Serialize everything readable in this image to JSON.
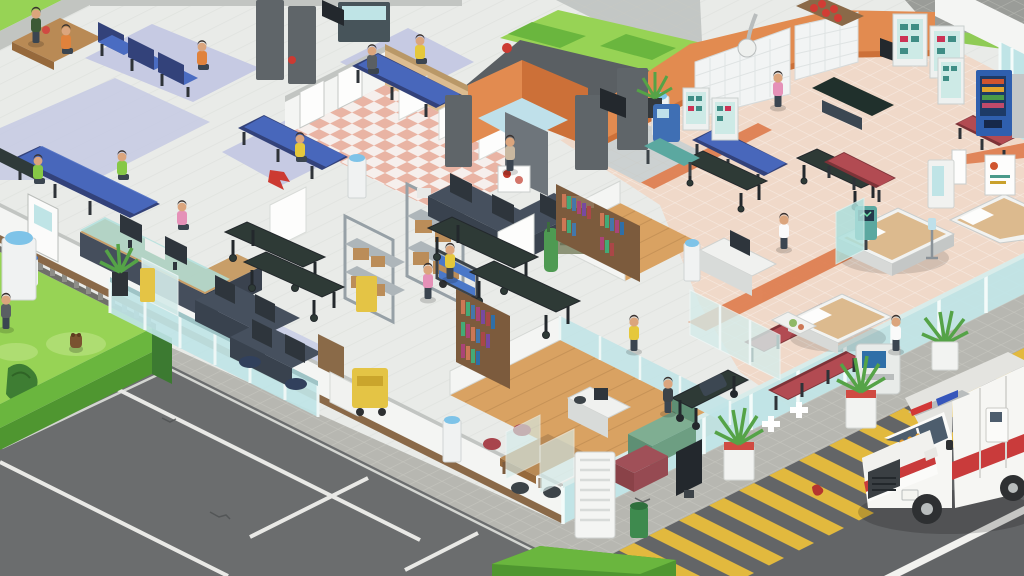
{
  "meta": {
    "view": "isometric-hospital-simulation-scene",
    "hud_text": ""
  },
  "palette": {
    "floor_base": "#e9ebe8",
    "plank_line": "#dde0dc",
    "rug_lavender": "#c6cae3",
    "office_floor": "#ccd1e6",
    "checker_a": "#f6efec",
    "checker_b": "#e9b4a4",
    "ward_tile": "#f0d9c9",
    "runner_orange": "#de7b4c",
    "wood_floor": "#d9a262",
    "wood_line": "#bb8950",
    "desk_wood": "#c89e68",
    "wall_white": "#f4f5f3",
    "wall_shade": "#e0e2df",
    "wall_cap": "#c2c5c2",
    "wall_beige": "#dcbc90",
    "wall_orange": "#e28b50",
    "wall_orange_dark": "#cc7038",
    "wall_dark": "#5a5f63",
    "grid_wall": "#f2f4f4",
    "glass_teal": "#bfe4e6",
    "glass_frame": "#eef7f6",
    "locker_dark": "#59666c",
    "locker_teal": "#47727a",
    "cabinet_glass": "#cdeae6",
    "chair_blue": "#4a6cc2",
    "chair_blue_dark": "#33427a",
    "chair_red": "#b24b52",
    "sofa_green": "#7fae92",
    "ottoman_red": "#a05058",
    "bookshelf_brown": "#7c5b3d",
    "shelf_metal": "#96a0a6",
    "box_brown": "#bb8d59",
    "bin_yellow": "#e4c445",
    "grass_bright": "#97d355",
    "grass_patch": "#aedd72",
    "hedge_top": "#6ab63e",
    "hedge_side": "#4f9630",
    "hedge_dark": "#3c7a31",
    "fence_gray": "#8e8e88",
    "parking": "#6b6d6e",
    "parking_line": "#e9e9e6",
    "sidewalk": "#b7b7b1",
    "sidewalk_line": "#c9c9c2",
    "hatch_yellow": "#e2b93e",
    "road": "#636567",
    "road_line": "#f2f2ef",
    "amb_body": "#f6f6f3",
    "amb_shade": "#dddddad",
    "amb_stripe": "#c93b3b",
    "amb_glass": "#4d5d6d",
    "light_red": "#d23737",
    "light_blue": "#3656bb",
    "tire": "#2e3032",
    "monitor_dark": "#2e353c",
    "screen_blue": "#4c6a85",
    "skin": "#dba57d",
    "hair_dark": "#3a3230",
    "scrub_pink": "#e591b8",
    "scrub_yellow": "#e5c83c",
    "coat_white": "#fafafa",
    "uniform_dark": "#3c4348",
    "shirt_green": "#86c846",
    "shirt_orange": "#e0823c",
    "plant_green": "#55a347",
    "pot_white": "#f2f3f1",
    "pot_red": "#d04a42",
    "water_blue": "#7ec3e8",
    "blood_red": "#b5352f",
    "olive_cab": "#8d9478",
    "coat_rack_green": "#4e9a52",
    "vending_blue": "#2f5fae",
    "bear_brown": "#7a5230"
  },
  "scene": {
    "areas": [
      {
        "id": "waiting-lobby",
        "label": "waiting lobby with blue seat rows"
      },
      {
        "id": "restrooms",
        "label": "restrooms with pink checkered floor"
      },
      {
        "id": "reception",
        "label": "reception desk with receptionist"
      },
      {
        "id": "open-office",
        "label": "open office with computer desks"
      },
      {
        "id": "storage-corridor",
        "label": "supply corridor with racks and carts"
      },
      {
        "id": "nurse-station",
        "label": "nurse station counters"
      },
      {
        "id": "records-room",
        "label": "records room with bookshelves"
      },
      {
        "id": "staff-lounge",
        "label": "staff lounge with sofa and tv"
      },
      {
        "id": "operating-suite",
        "label": "operating suite with orange walls"
      },
      {
        "id": "inpatient-ward",
        "label": "inpatient ward with beds"
      },
      {
        "id": "entrance",
        "label": "glass entrance with cross decals"
      },
      {
        "id": "vending-corner",
        "label": "vending machine corner"
      },
      {
        "id": "parking-lot",
        "label": "parking lot"
      },
      {
        "id": "ambulance-bay",
        "label": "street with hatched ambulance bay"
      },
      {
        "id": "garden",
        "label": "garden with hedge, fence and groundhog"
      }
    ],
    "people": [
      {
        "id": "visitor-walking-topleft",
        "outfit": "dark green jacket"
      },
      {
        "id": "visitor-orange-table",
        "outfit": "orange shirt"
      },
      {
        "id": "visitor-orange-seated",
        "outfit": "orange shirt"
      },
      {
        "id": "visitor-gray-seated",
        "outfit": "gray jacket"
      },
      {
        "id": "visitor-yellow-seated-1",
        "outfit": "yellow shirt"
      },
      {
        "id": "visitor-yellow-seated-2",
        "outfit": "yellow shirt"
      },
      {
        "id": "visitor-green-seated-1",
        "outfit": "green shirt"
      },
      {
        "id": "visitor-green-seated-2",
        "outfit": "green shirt"
      },
      {
        "id": "receptionist",
        "outfit": "pink top"
      },
      {
        "id": "nurse-corridor",
        "outfit": "pink scrubs"
      },
      {
        "id": "orderly-with-cart",
        "outfit": "yellow scrubs"
      },
      {
        "id": "woman-yellow-walking",
        "outfit": "yellow dress"
      },
      {
        "id": "paramedic-stretcher",
        "outfit": "dark uniform"
      },
      {
        "id": "nurse-or",
        "outfit": "pink scrubs"
      },
      {
        "id": "doctor-ward",
        "outfit": "white coat"
      },
      {
        "id": "doctor-entrance",
        "outfit": "white coat"
      },
      {
        "id": "visitor-at-sink",
        "outfit": "blonde visitor"
      },
      {
        "id": "patient-in-bed",
        "outfit": "tan blanket"
      }
    ],
    "objects": {
      "ambulance": {
        "body": "white",
        "stripe": "red",
        "lightbar": [
          "red",
          "blue"
        ],
        "state": "parked on hatched bay"
      },
      "hospital_beds": 3,
      "stretchers": 6,
      "water_coolers": 6,
      "bookshelves": 3,
      "vending_machines": 1,
      "blue_seat_rows": 5,
      "red_seat_rows": 4,
      "potted_plants": 9,
      "storage_racks": 2,
      "biohazard_bins": 3,
      "operating_table": 1,
      "toilet_stalls": 3,
      "glass_cross_doors": 2,
      "groundhog": 1,
      "tv": 1,
      "sofa": 1
    }
  }
}
